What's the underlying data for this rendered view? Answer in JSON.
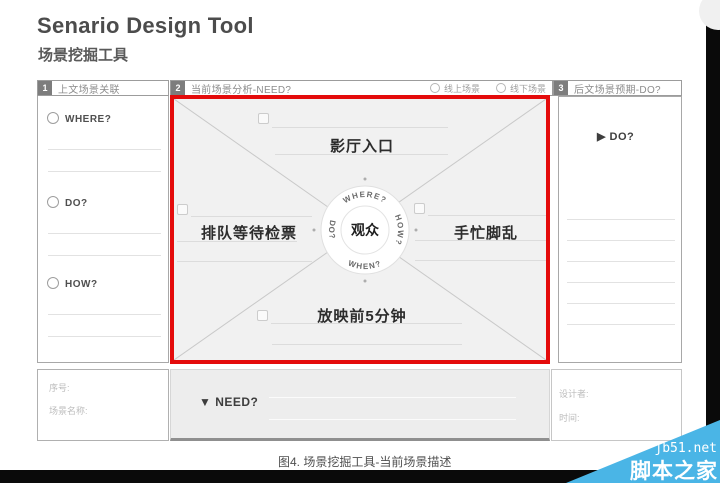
{
  "title": "Senario Design Tool",
  "subtitle": "场景挖掘工具",
  "caption": "图4. 场景挖掘工具-当前场景描述",
  "colors": {
    "accent_red": "#e40b0b",
    "watermark_blue": "#4ab5e6",
    "panel_gray": "#f1f1f1"
  },
  "header": {
    "s1": {
      "num": "1",
      "label": "上文场景关联"
    },
    "s2": {
      "num": "2",
      "label": "当前场景分析-NEED?",
      "radio1": "线上场景",
      "radio2": "线下场景"
    },
    "s3": {
      "num": "3",
      "label": "后文场景预期-DO?"
    }
  },
  "left_panel": {
    "items": [
      {
        "label": "WHERE?"
      },
      {
        "label": "DO?"
      },
      {
        "label": "HOW?"
      }
    ]
  },
  "center_panel": {
    "hub": "观众",
    "compass": {
      "top": "WHERE?",
      "right": "HOW?",
      "bottom": "WHEN?",
      "left": "DO?"
    },
    "quadrants": {
      "top": "影厅入口",
      "left": "排队等待检票",
      "right": "手忙脚乱",
      "bottom": "放映前5分钟"
    }
  },
  "right_panel": {
    "do_label": "▶ DO?"
  },
  "footer": {
    "serial": "序号:",
    "scene_name": "场景名称:",
    "need": "▼ NEED?",
    "designer": "设计者:",
    "time": "时间:"
  },
  "watermark": {
    "site": "jb51.net",
    "name": "脚本之家"
  }
}
